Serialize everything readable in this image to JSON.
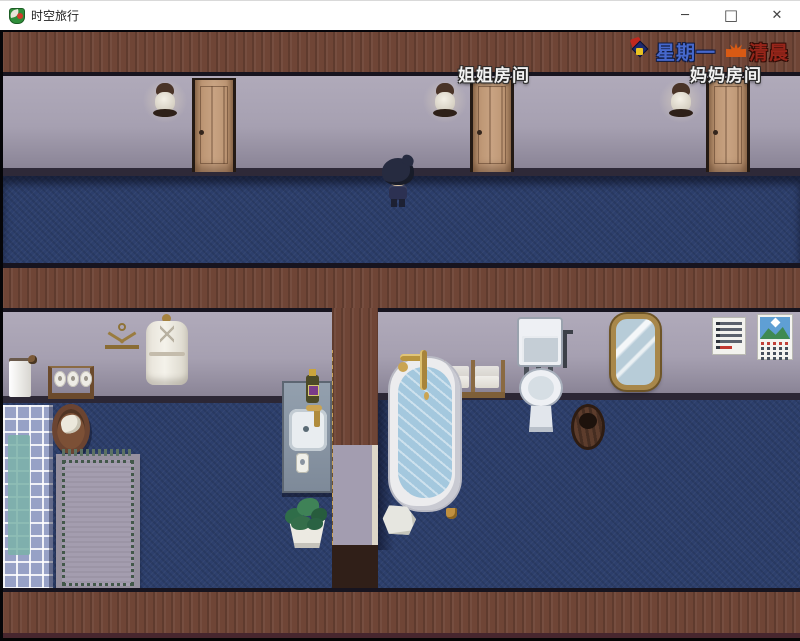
{
  "window": {
    "title": "时空旅行",
    "controls": {
      "minimize": "─",
      "maximize": "□",
      "close": "✕"
    }
  },
  "hud": {
    "day": "星期一",
    "time": "清晨"
  },
  "scene": {
    "room_labels": [
      {
        "text": "姐姐房间"
      },
      {
        "text": "妈妈房间"
      }
    ]
  },
  "colors": {
    "hud_day_text": "#4668cc",
    "hud_time_text": "#97251a",
    "wood_band": "#6f4536",
    "wall": "#a6a0b1",
    "carpet": "#2d3f6c",
    "tile_floor": "#97a1c6",
    "tile_teal": "#7ab2a8"
  }
}
